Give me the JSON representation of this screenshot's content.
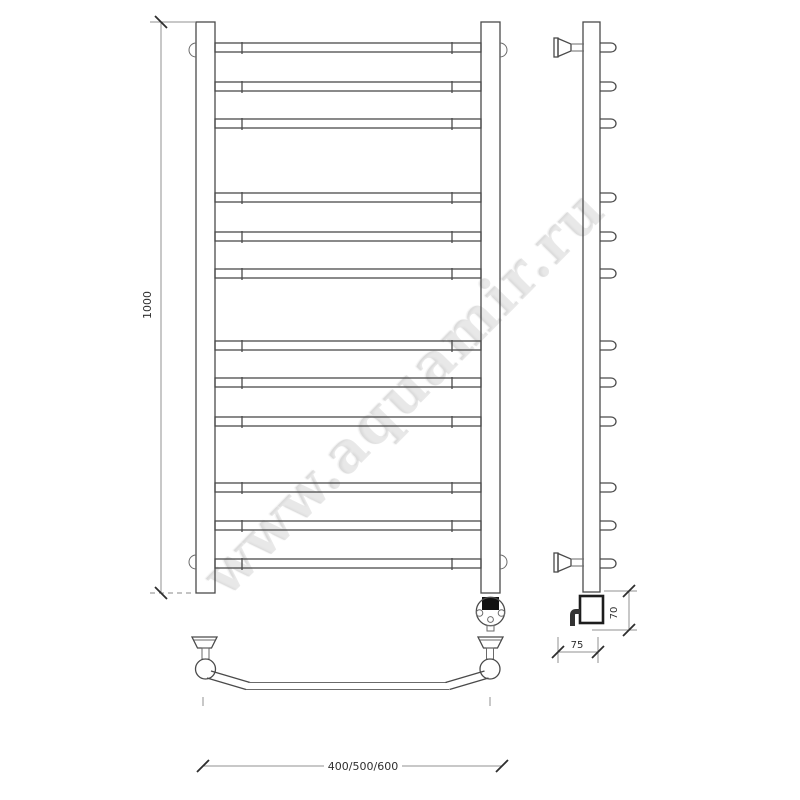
{
  "watermark": {
    "text": "www.aquamir.ru"
  },
  "dimensions": {
    "overall_height": "1000",
    "overall_width": "400/500/600",
    "wall_offset": "75",
    "heater_height": "70"
  },
  "front_view": {
    "rung_count": 12,
    "rung_y": [
      43,
      82,
      119,
      193,
      232,
      269,
      341,
      378,
      417,
      483,
      521,
      559
    ],
    "rung_thickness": 9,
    "bend_tick_x": [
      242,
      452
    ]
  },
  "colors": {
    "line": "#4a4a4a",
    "extension_line": "#909090",
    "heavy_line": "#1d1d1d",
    "heater_fill": "#111111",
    "watermark": "#bdbdbd",
    "background": "#ffffff"
  }
}
